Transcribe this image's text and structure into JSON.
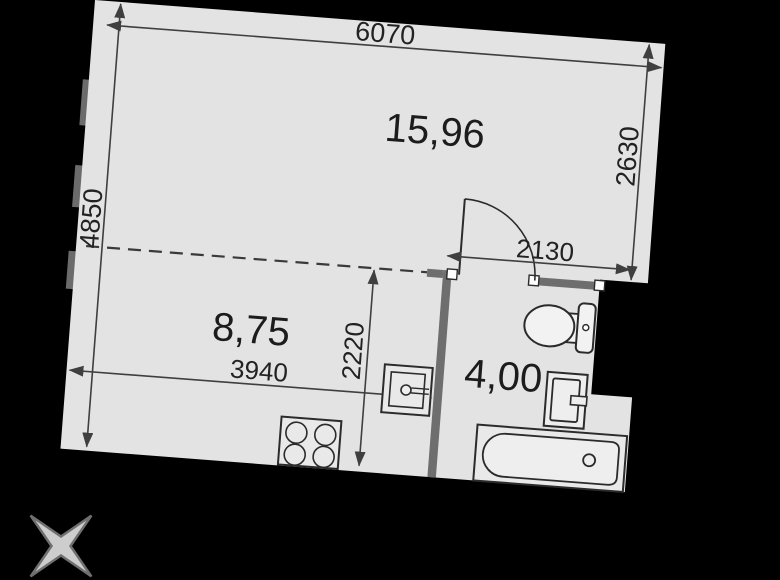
{
  "window": {
    "width": 780,
    "height": 580
  },
  "floor_plan": {
    "rooms": [
      {
        "id": "living",
        "area_label": "15,96"
      },
      {
        "id": "kitchen",
        "area_label": "8,75"
      },
      {
        "id": "bathroom",
        "area_label": "4,00"
      }
    ],
    "dimensions_mm": {
      "top_width": "6070",
      "left_height": "4850",
      "right_room_depth": "2630",
      "door_wall_width": "2130",
      "kitchen_width": "3940",
      "kitchen_depth": "2220"
    },
    "symbols": [
      "stove",
      "kitchen-sink",
      "door-swing",
      "toilet",
      "washbasin",
      "bathtub",
      "compass-star"
    ],
    "colors": {
      "background": "#000000",
      "floor": "#e3e3e3",
      "thick_wall": "#6e6e6e",
      "line": "#2e2e2e",
      "text": "#1c1c1c",
      "star": "#cdcdcd"
    }
  }
}
